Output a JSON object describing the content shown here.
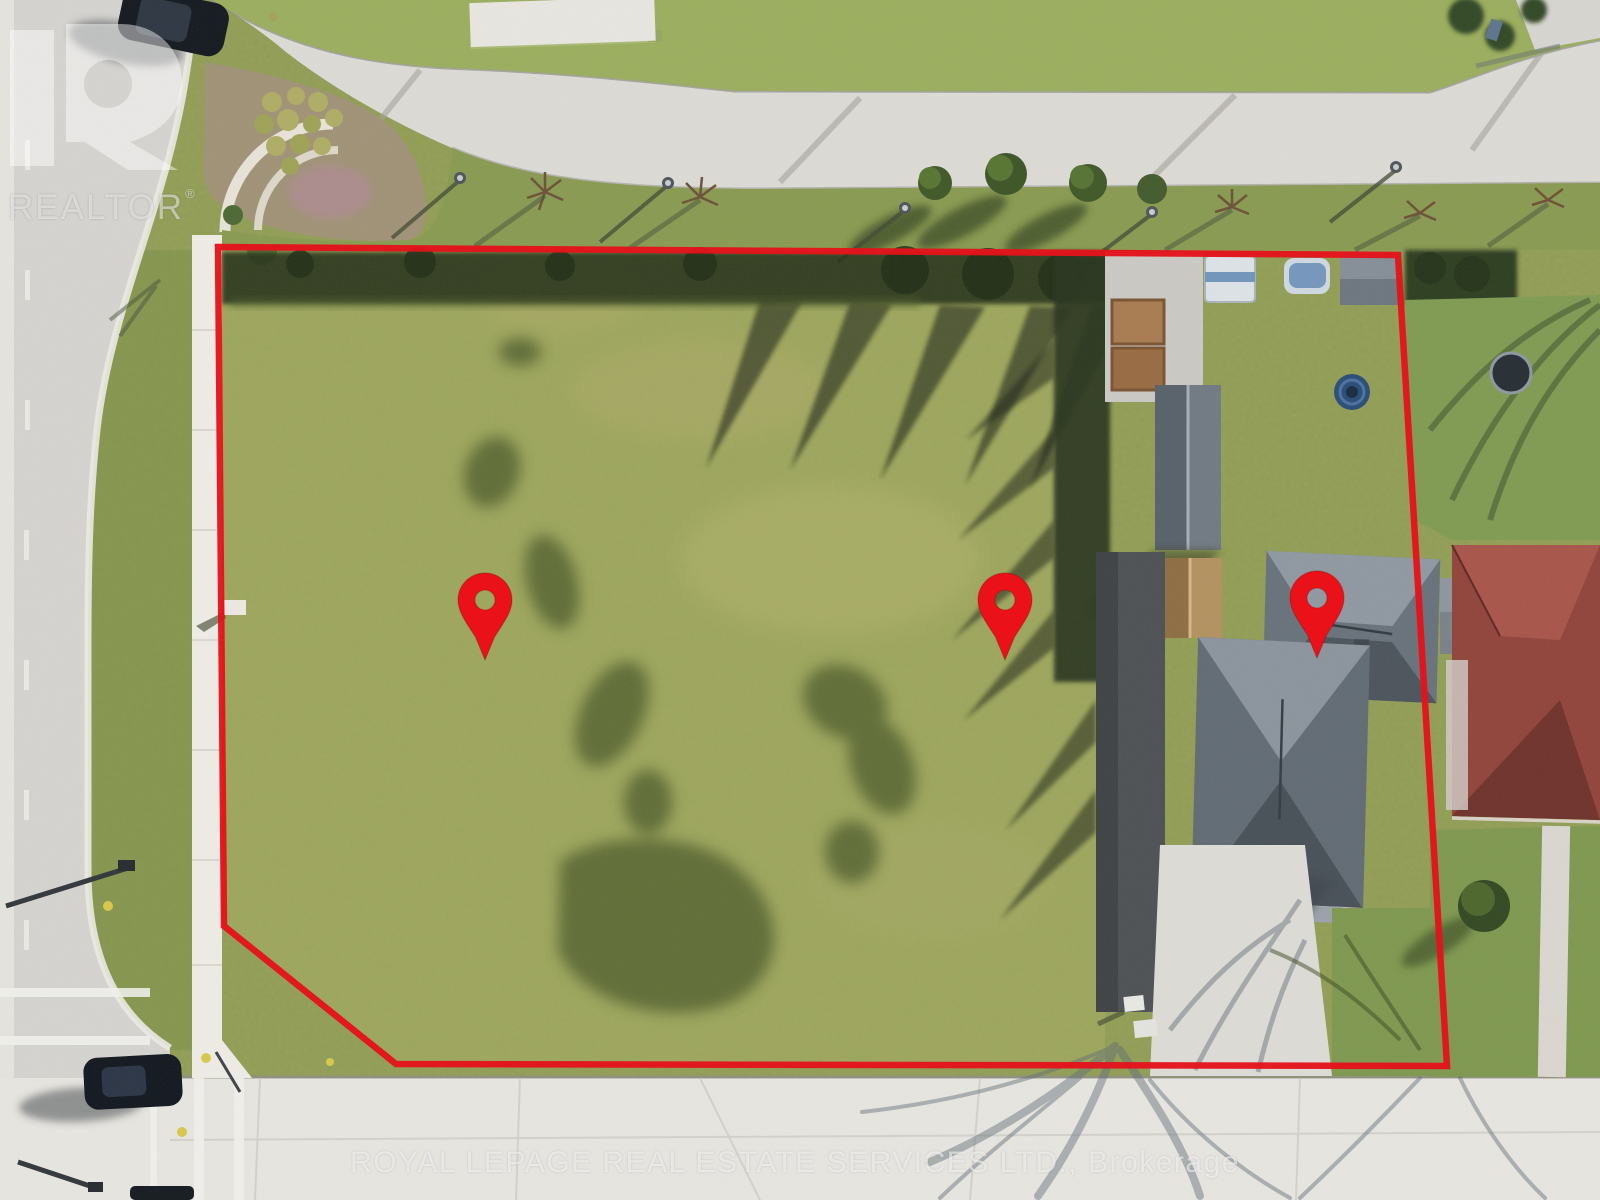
{
  "watermarks": {
    "realtor_letter": "R",
    "realtor_label": "REALTOR",
    "registered_mark": "®",
    "brokerage_line": "ROYAL LEPAGE REAL ESTATE SERVICES LTD.,  Brokerage"
  },
  "overlay": {
    "boundary_vertices": [
      [
        218,
        247
      ],
      [
        1398,
        255
      ],
      [
        1447,
        1066
      ],
      [
        396,
        1064
      ],
      [
        224,
        926
      ],
      [
        218,
        247
      ]
    ],
    "pins": [
      {
        "name": "location-pin-west",
        "cx": 485,
        "cy": 600
      },
      {
        "name": "location-pin-middle",
        "cx": 1005,
        "cy": 600
      },
      {
        "name": "location-pin-east",
        "cx": 1317,
        "cy": 598
      }
    ]
  },
  "palette": {
    "boundary_red": "#e4131b",
    "marker_red": "#ea1118",
    "lot_grass": "#9ea75d",
    "surrounding_grass": "#85984e",
    "road_asphalt": "#d6d4d0",
    "street_concrete": "#e8e6e1",
    "sidewalk": "#efede6",
    "roof_gray": "#667079",
    "roof_red": "#8f4138"
  }
}
